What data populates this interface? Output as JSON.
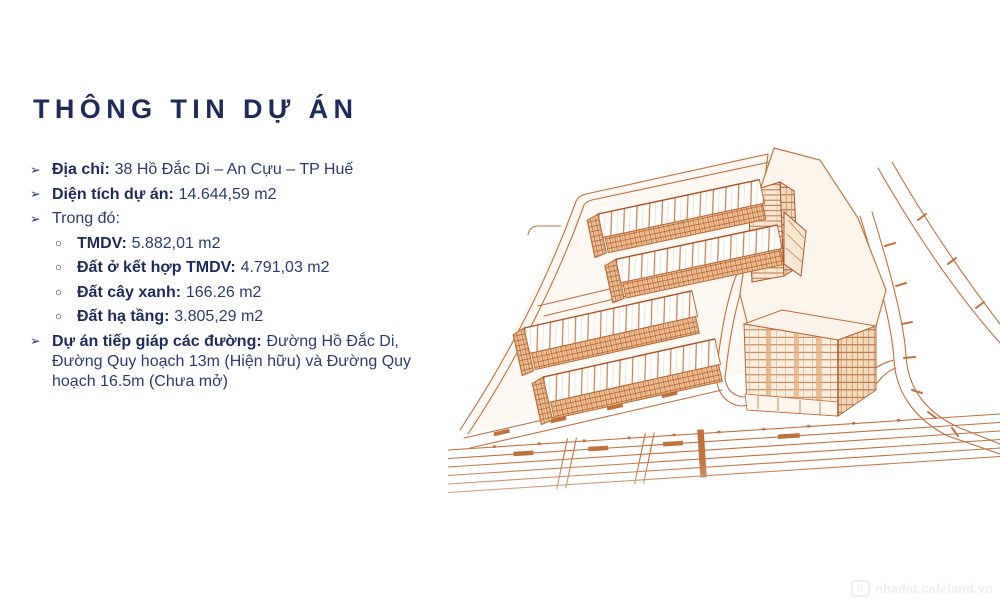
{
  "slide": {
    "title": "THÔNG TIN DỰ ÁN",
    "bullets": {
      "address": {
        "marker": "➢",
        "label": "Địa chỉ:",
        "value": "38 Hồ Đắc Di – An Cựu – TP Huế"
      },
      "area": {
        "marker": "➢",
        "label": "Diện tích dự án:",
        "value": "14.644,59 m2"
      },
      "including": {
        "marker": "➢",
        "value": "Trong đó:"
      },
      "sub": [
        {
          "marker": "○",
          "label": "TMDV:",
          "value": "5.882,01 m2"
        },
        {
          "marker": "○",
          "label": "Đất ở kết hợp TMDV:",
          "value": "4.791,03 m2"
        },
        {
          "marker": "○",
          "label": "Đất cây xanh:",
          "value": "166.26 m2"
        },
        {
          "marker": "○",
          "label": "Đất hạ tầng:",
          "value": "3.805,29 m2"
        }
      ],
      "adjacent": {
        "marker": "➢",
        "label": "Dự án tiếp giáp các đường:",
        "value": "Đường Hồ Đắc Di, Đường Quy hoạch 13m (Hiện hữu) và Đường Quy hoạch 16.5m (Chưa mở)"
      }
    },
    "illustration": {
      "name": "isometric-site-plan-line-drawing",
      "description": "Orange line-art master plan: two blocks of rowhouses with striped roofs, a high-rise tower with window grid, a thin slab tower, surrounding roads"
    },
    "watermark": {
      "icon": "camera-icon",
      "text": "nhadat.cafeland.vn"
    },
    "colors": {
      "navy": "#1e2b5a",
      "body_navy": "#2c3b6d",
      "line_orange": "#bf7140",
      "facade_orange": "#f1c69e"
    }
  }
}
